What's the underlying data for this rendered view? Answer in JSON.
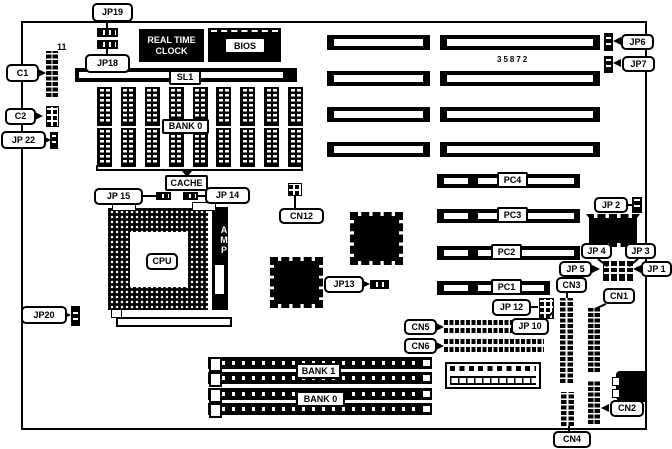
{
  "diagram": {
    "type": "motherboard-layout",
    "board_ref": "35872",
    "corner_note": "11",
    "labels": {
      "jp19": "JP19",
      "jp18": "JP18",
      "c1": "C1",
      "c2": "C2",
      "jp22": "JP 22",
      "jp20": "JP20",
      "jp15": "JP 15",
      "jp14": "JP 14",
      "jp13": "JP13",
      "cn12": "CN12",
      "cpu": "CPU",
      "amp": "AMP",
      "rtc_line1": "REAL TIME",
      "rtc_line2": "CLOCK",
      "bios": "BIOS",
      "sl1": "SL1",
      "cache_bank": "BANK 0",
      "cache": "CACHE",
      "jp6": "JP6",
      "jp7": "JP7",
      "pc4": "PC4",
      "pc3": "PC3",
      "pc2": "PC2",
      "pc1": "PC1",
      "jp2": "JP 2",
      "jp4": "JP 4",
      "jp3": "JP 3",
      "jp5": "JP 5",
      "jp1": "JP 1",
      "cn3": "CN3",
      "cn1": "CN1",
      "jp12": "JP 12",
      "jp10": "JP 10",
      "cn5": "CN5",
      "cn6": "CN6",
      "cn2": "CN2",
      "cn4": "CN4",
      "bank1": "BANK 1",
      "bank0": "BANK 0"
    },
    "colors": {
      "ink": "#000000",
      "paper": "#ffffff"
    }
  }
}
